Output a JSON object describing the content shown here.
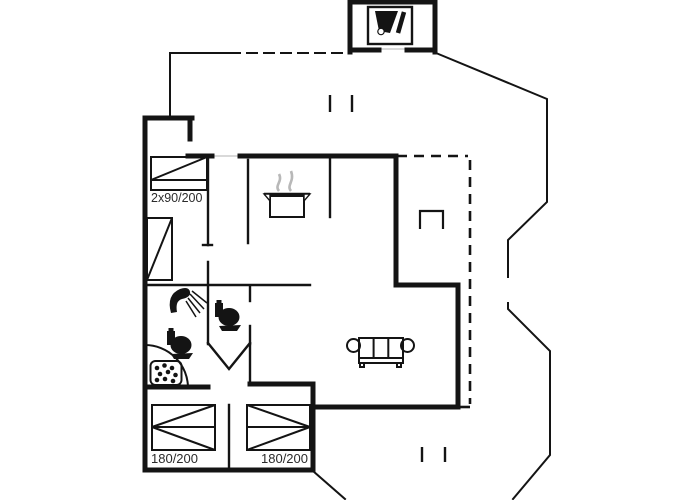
{
  "floorplan": {
    "background_color": "#ffffff",
    "line_color": "#141414",
    "steam_color": "#b8b8b8",
    "labels": {
      "bedroom1_bed": "2x90/200",
      "bedroom2_bed": "180/200",
      "bedroom3_bed": "180/200"
    },
    "icons": [
      "grill-stove-icon",
      "cooking-pot-icon",
      "shower-icon",
      "toilet-icon",
      "toilet-icon",
      "spa-bath-icon",
      "sofa-icon",
      "double-bed-icon",
      "double-bed-icon",
      "double-bed-icon",
      "wardrobe-icon",
      "terrace-table-icon"
    ]
  }
}
